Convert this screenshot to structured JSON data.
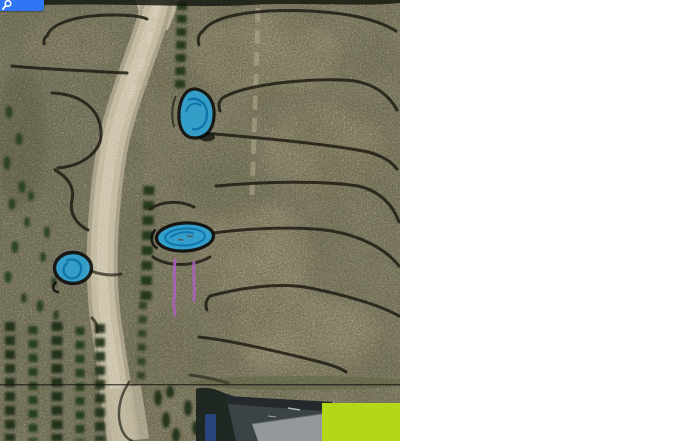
{
  "window": {
    "width_px": 700,
    "height_px": 441,
    "canvas_background": "#ffffff"
  },
  "toolbar": {
    "search_button": {
      "icon": "search-icon",
      "background": "#2e76f3",
      "icon_color": "#ffffff"
    }
  },
  "map": {
    "kind": "satellite-aerial-photo",
    "viewport": {
      "width_px": 400,
      "height_px": 441
    },
    "terrain": {
      "field_color": "#8a8571",
      "road_color": "#cdc4ac",
      "tree_color": "#1e3419",
      "contour_line_color": "#211f16",
      "description": "dirt road winding top-to-bottom, tree rows on left, contoured swale lines on right field, building roof at bottom"
    },
    "tile_seam_y": 385,
    "annotations": {
      "ponds": {
        "fill": "#2ba3d8",
        "outline": "#0c0c0c",
        "items": [
          {
            "name": "teardrop-pond",
            "cx": 196,
            "cy": 113
          },
          {
            "name": "oval-pond",
            "cx": 185,
            "cy": 237
          },
          {
            "name": "round-pond",
            "cx": 73,
            "cy": 268
          }
        ]
      },
      "marker_lines": {
        "color": "#b060c2",
        "items": [
          {
            "name": "left-marker-line",
            "x": 175,
            "y1": 260,
            "y2": 315
          },
          {
            "name": "right-marker-line",
            "x": 194,
            "y1": 262,
            "y2": 300
          }
        ]
      },
      "highlight_rect": {
        "color": "#b3d916",
        "x": 322,
        "y": 403,
        "width": 78,
        "height": 38
      }
    }
  },
  "colors": {
    "pond_blue": "#2ba3d8",
    "pond_inner_blue": "#0e6da6",
    "marker_magenta": "#b060c2",
    "highlight_green": "#b3d916",
    "button_blue": "#2e76f3",
    "white": "#ffffff"
  }
}
